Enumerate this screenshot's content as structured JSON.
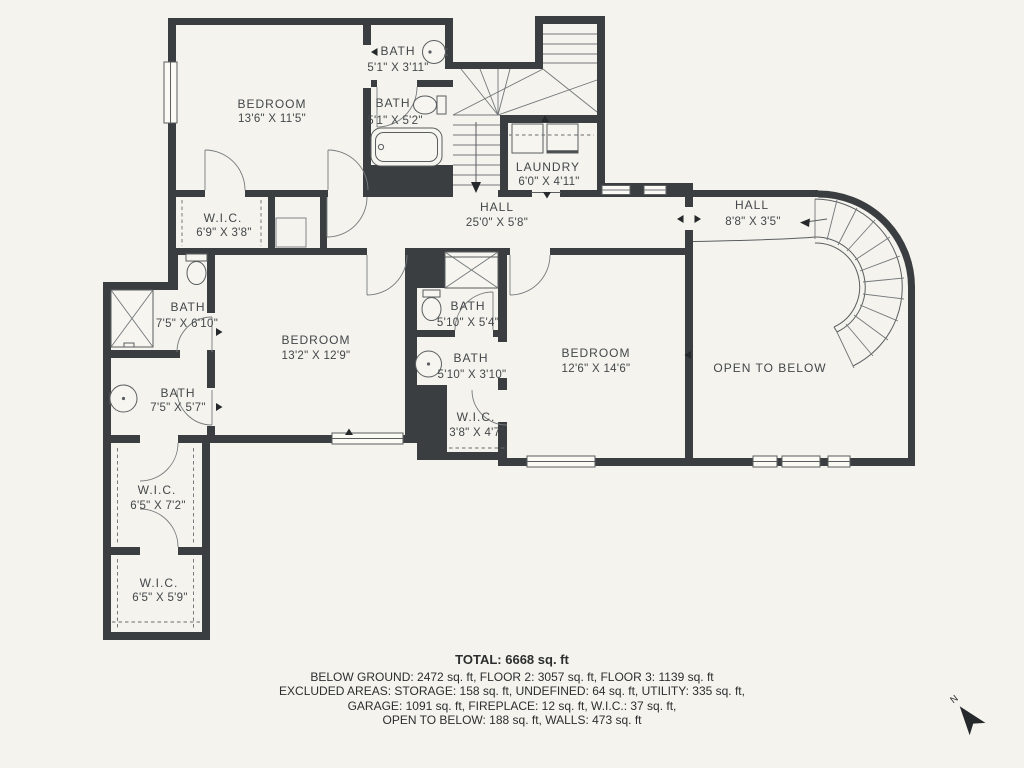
{
  "colors": {
    "background": "#f4f3ed",
    "wall": "#3a3e41",
    "thin_line": "#5a5e60",
    "label_text": "#43474a",
    "summary_text": "#2c2e2f"
  },
  "rooms": {
    "bedroom_top": {
      "name": "BEDROOM",
      "dims": "13'6\" X 11'5\""
    },
    "bath_top_1": {
      "name": "BATH",
      "dims": "5'1\" X 3'11\""
    },
    "bath_top_2": {
      "name": "BATH",
      "dims": "5'1\" X 5'2\""
    },
    "laundry": {
      "name": "LAUNDRY",
      "dims": "6'0\" X 4'11\""
    },
    "hall_main": {
      "name": "HALL",
      "dims": "25'0\" X 5'8\""
    },
    "hall_right": {
      "name": "HALL",
      "dims": "8'8\" X 3'5\""
    },
    "wic_top": {
      "name": "W.I.C.",
      "dims": "6'9\" X 3'8\""
    },
    "bath_left_1": {
      "name": "BATH",
      "dims": "7'5\" X 6'10\""
    },
    "bath_left_2": {
      "name": "BATH",
      "dims": "7'5\" X 5'7\""
    },
    "bedroom_mid": {
      "name": "BEDROOM",
      "dims": "13'2\" X 12'9\""
    },
    "bath_mid_1": {
      "name": "BATH",
      "dims": "5'10\" X 5'4\""
    },
    "bath_mid_2": {
      "name": "BATH",
      "dims": "5'10\" X 3'10\""
    },
    "wic_mid": {
      "name": "W.I.C.",
      "dims": "3'8\" X 4'7\""
    },
    "bedroom_right": {
      "name": "BEDROOM",
      "dims": "12'6\" X 14'6\""
    },
    "open_below": {
      "name": "OPEN TO BELOW"
    },
    "wic_bottom_1": {
      "name": "W.I.C.",
      "dims": "6'5\" X 7'2\""
    },
    "wic_bottom_2": {
      "name": "W.I.C.",
      "dims": "6'5\" X 5'9\""
    }
  },
  "summary": {
    "total": "TOTAL: 6668 sq. ft",
    "line_1": "BELOW GROUND: 2472 sq. ft, FLOOR 2: 3057 sq. ft, FLOOR 3: 1139 sq. ft",
    "line_2": "EXCLUDED AREAS: STORAGE: 158 sq. ft, UNDEFINED: 64 sq. ft, UTILITY: 335 sq. ft,",
    "line_3": "GARAGE: 1091 sq. ft, FIREPLACE: 12 sq. ft, W.I.C.: 37 sq. ft,",
    "line_4": "OPEN TO BELOW: 188 sq. ft, WALLS: 473 sq. ft"
  },
  "compass": {
    "label": "N"
  }
}
